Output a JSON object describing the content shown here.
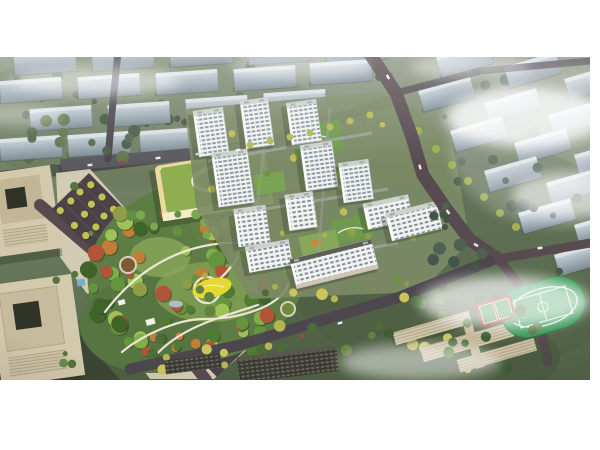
{
  "palette": {
    "background": "#ffffff",
    "ground_top": "#8a9480",
    "ground_mid": "#6e7e61",
    "ground_bottom": "#55674a",
    "far_building_top": "#cdd7dc",
    "far_building_face": "#7e8b95",
    "tower_facade": "#f2f4f2",
    "tower_window": "#8a97a3",
    "tower_roof": "#cdd2cd",
    "road": "#4b474d",
    "road_brown": "#574b50",
    "avenue_road": "#4a4247",
    "park_green": "#5d7d44",
    "park_path": "#ece6d4",
    "playground_yellow": "#e6d832",
    "tree_dark": "#3e6429",
    "tree_yellow": "#c2c253",
    "kindergarten_roof": "#8fae4f",
    "kindergarten_wall": "#ead9a0",
    "office_facade": "#d3c9ad",
    "dark_building": "#3a3a33",
    "school_building": "#cdc3a8",
    "field_turf": "#379a58",
    "court_red": "#ad4038",
    "cloud": "#ffffff"
  },
  "scene": {
    "kind": "aerial-architectural-rendering",
    "residential_tower_count": 12,
    "office_tower_count": 2,
    "kindergarten_count": 1,
    "school_building_count": 3,
    "sports_field_count": 1,
    "regions": [
      {
        "name": "far-city-blocks"
      },
      {
        "name": "residential-compound"
      },
      {
        "name": "central-park"
      },
      {
        "name": "kindergarten"
      },
      {
        "name": "office-towers"
      },
      {
        "name": "tree-lined-avenue"
      },
      {
        "name": "school-campus"
      },
      {
        "name": "sports-field"
      },
      {
        "name": "clouds"
      }
    ]
  }
}
